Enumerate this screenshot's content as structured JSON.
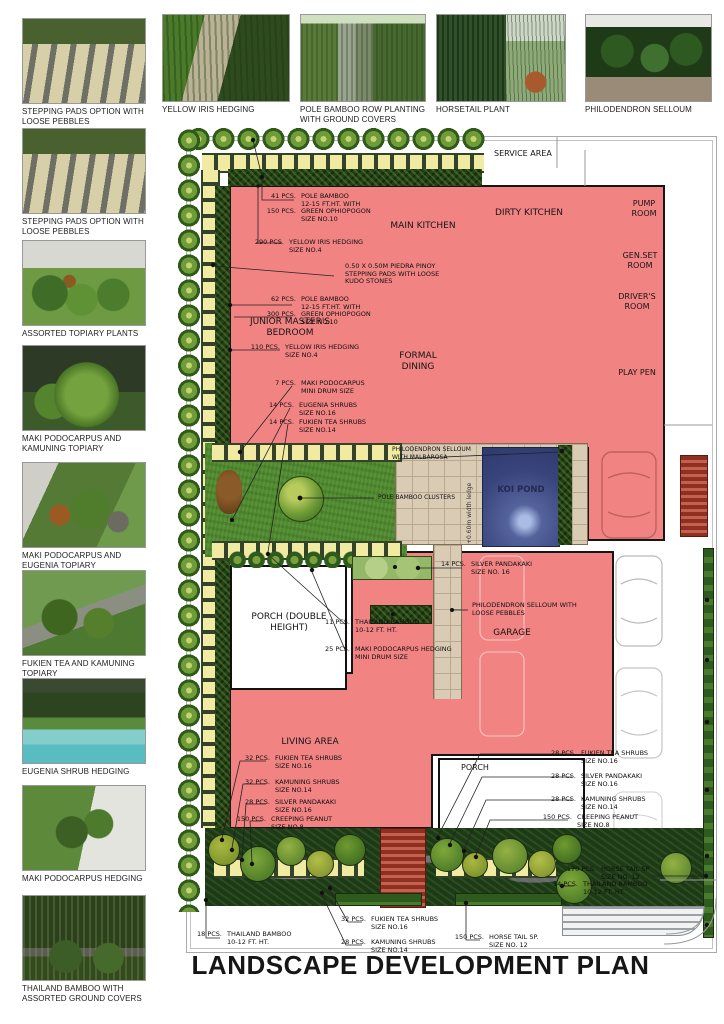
{
  "title": "LANDSCAPE DEVELOPMENT PLAN",
  "colors": {
    "building_pink": "#F28383",
    "pond_blue": "#39447C",
    "pad_yellow": "#F0EAA2",
    "lawn_green": "#4E8A2C",
    "hedge_dark": "#224012",
    "paving_tan": "#DACBB5",
    "brick_red": "#A83828"
  },
  "gallery": {
    "left": [
      {
        "caption": "STEPPING PADS OPTION WITH LOOSE PEBBLES"
      },
      {
        "caption": "STEPPING PADS OPTION WITH LOOSE PEBBLES"
      },
      {
        "caption": "ASSORTED TOPIARY PLANTS"
      },
      {
        "caption": "MAKI PODOCARPUS AND KAMUNING TOPIARY"
      },
      {
        "caption": "MAKI PODOCARPUS AND EUGENIA TOPIARY"
      },
      {
        "caption": "FUKIEN TEA AND KAMUNING TOPIARY"
      },
      {
        "caption": "EUGENIA SHRUB HEDGING"
      },
      {
        "caption": "MAKI PODOCARPUS HEDGING"
      },
      {
        "caption": "THAILAND BAMBOO WITH ASSORTED GROUND COVERS"
      }
    ],
    "top": [
      {
        "caption": "YELLOW IRIS HEDGING"
      },
      {
        "caption": "POLE BAMBOO ROW PLANTING WITH GROUND COVERS"
      },
      {
        "caption": "HORSETAIL PLANT"
      },
      {
        "caption": "PHILODENDRON SELLOUM"
      }
    ]
  },
  "plan": {
    "rooms": {
      "service": "SERVICE AREA",
      "dirty_kitchen": "DIRTY KITCHEN",
      "main_kitchen": "MAIN KITCHEN",
      "pump_room": "PUMP ROOM",
      "genset_room": "GEN.SET ROOM",
      "drivers_room": "DRIVER'S ROOM",
      "play_pen": "PLAY PEN",
      "junior_bedroom": "JUNIOR MASTER'S BEDROOM",
      "formal_dining": "FORMAL DINING",
      "koi_pond": "KOI POND",
      "porch_double": "PORCH (DOUBLE HEIGHT)",
      "garage": "GARAGE",
      "living_area": "LIVING AREA",
      "porch": "PORCH",
      "ledge": "+0.60m width ledge"
    },
    "notes": [
      {
        "rows": [
          {
            "q": "41 PCS.",
            "t": "POLE BAMBOO"
          },
          {
            "q": "",
            "t": "12-15 FT.HT. WITH"
          },
          {
            "q": "150 PCS.",
            "t": "GREEN OPHIOPOGON"
          },
          {
            "q": "",
            "t": "SIZE NO.10"
          }
        ]
      },
      {
        "rows": [
          {
            "q": "290 PCS.",
            "t": "YELLOW IRIS HEDGING"
          },
          {
            "q": "",
            "t": "SIZE NO.4"
          }
        ]
      },
      {
        "rows": [
          {
            "q": "",
            "t": "0.50 X 0.50M PIEDRA PINOY"
          },
          {
            "q": "",
            "t": "STEPPING PADS WITH LOOSE"
          },
          {
            "q": "",
            "t": "KUDO STONES"
          }
        ]
      },
      {
        "rows": [
          {
            "q": "62 PCS.",
            "t": "POLE BAMBOO"
          },
          {
            "q": "",
            "t": "12-15 FT.HT. WITH"
          },
          {
            "q": "300 PCS.",
            "t": "GREEN OPHIOPOGON"
          },
          {
            "q": "",
            "t": "SIZE NO.10"
          }
        ]
      },
      {
        "rows": [
          {
            "q": "110 PCS.",
            "t": "YELLOW IRIS HEDGING"
          },
          {
            "q": "",
            "t": "SIZE NO.4"
          }
        ]
      },
      {
        "rows": [
          {
            "q": "7 PCS.",
            "t": "MAKI PODOCARPUS"
          },
          {
            "q": "",
            "t": "MINI DRUM SIZE"
          }
        ]
      },
      {
        "rows": [
          {
            "q": "14 PCS.",
            "t": "EUGENIA SHRUBS"
          },
          {
            "q": "",
            "t": "SIZE NO.16"
          }
        ]
      },
      {
        "rows": [
          {
            "q": "14 PCS.",
            "t": "FUKIEN TEA SHRUBS"
          },
          {
            "q": "",
            "t": "SIZE NO.14"
          }
        ]
      },
      {
        "rows": [
          {
            "q": "14 PCS.",
            "t": "SILVER PANDAKAKI"
          },
          {
            "q": "",
            "t": "SIZE NO. 16"
          }
        ]
      },
      {
        "rows": [
          {
            "q": "",
            "t": "PHILODENDRON SELLOUM WITH"
          },
          {
            "q": "",
            "t": "LOOSE PEBBLES"
          }
        ]
      },
      {
        "rows": [
          {
            "q": "11 PCS.",
            "t": "THAILAND BAMBOO"
          },
          {
            "q": "",
            "t": "10-12 FT. HT."
          }
        ]
      },
      {
        "rows": [
          {
            "q": "25 PCS.",
            "t": "MAKI PODOCARPUS HEDGING"
          },
          {
            "q": "",
            "t": "MINI DRUM SIZE"
          }
        ]
      },
      {
        "rows": [
          {
            "q": "32 PCS.",
            "t": "FUKIEN TEA SHRUBS"
          },
          {
            "q": "",
            "t": "SIZE NO.16"
          }
        ]
      },
      {
        "rows": [
          {
            "q": "32 PCS.",
            "t": "KAMUNING SHRUBS"
          },
          {
            "q": "",
            "t": "SIZE NO.14"
          }
        ]
      },
      {
        "rows": [
          {
            "q": "28 PCS.",
            "t": "SILVER PANDAKAKI"
          },
          {
            "q": "",
            "t": "SIZE NO.16"
          }
        ]
      },
      {
        "rows": [
          {
            "q": "150 PCS.",
            "t": "CREEPING PEANUT"
          },
          {
            "q": "",
            "t": "SIZE NO.8"
          }
        ]
      },
      {
        "rows": [
          {
            "q": "28 PCS.",
            "t": "FUKIEN TEA SHRUBS"
          },
          {
            "q": "",
            "t": "SIZE NO.16"
          }
        ]
      },
      {
        "rows": [
          {
            "q": "28 PCS.",
            "t": "SILVER PANDAKAKI"
          },
          {
            "q": "",
            "t": "SIZE NO.16"
          }
        ]
      },
      {
        "rows": [
          {
            "q": "28 PCS.",
            "t": "KAMUNING SHRUBS"
          },
          {
            "q": "",
            "t": "SIZE NO.14"
          }
        ]
      },
      {
        "rows": [
          {
            "q": "150 PCS.",
            "t": "CREEPING PEANUT"
          },
          {
            "q": "",
            "t": "SIZE NO.8"
          }
        ]
      },
      {
        "rows": [
          {
            "q": "170 PCS.",
            "t": "HORSE TAIL SP"
          },
          {
            "q": "",
            "t": "SIZE NO. 12"
          }
        ]
      },
      {
        "rows": [
          {
            "q": "14 PCS.",
            "t": "THAILAND BAMBOO"
          },
          {
            "q": "",
            "t": "10-12 FT. HT."
          }
        ]
      },
      {
        "rows": [
          {
            "q": "18 PCS.",
            "t": "THAILAND BAMBOO"
          },
          {
            "q": "",
            "t": "10-12 FT. HT."
          }
        ]
      },
      {
        "rows": [
          {
            "q": "32 PCS.",
            "t": "FUKIEN TEA SHRUBS"
          },
          {
            "q": "",
            "t": "SIZE NO.16"
          }
        ]
      },
      {
        "rows": [
          {
            "q": "28 PCS.",
            "t": "KAMUNING SHRUBS"
          },
          {
            "q": "",
            "t": "SIZE NO.14"
          }
        ]
      },
      {
        "rows": [
          {
            "q": "150 PCS.",
            "t": "HORSE TAIL SP."
          },
          {
            "q": "",
            "t": "SIZE NO. 12"
          }
        ]
      },
      {
        "rows": [
          {
            "q": "",
            "t": "PHILODENDRON SELLOUM"
          },
          {
            "q": "",
            "t": "WITH MALBAROSA"
          }
        ]
      },
      {
        "rows": [
          {
            "q": "",
            "t": "POLE BAMBOO CLUSTERS"
          }
        ]
      }
    ]
  }
}
